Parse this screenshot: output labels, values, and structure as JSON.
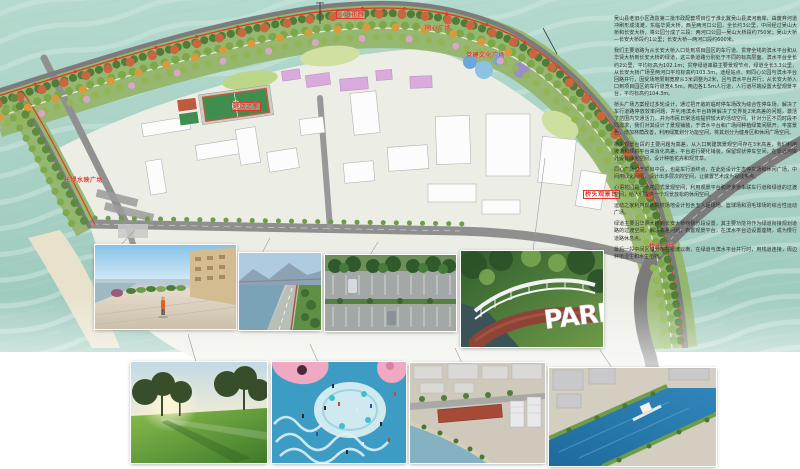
{
  "board": {
    "water_color": "#a6cfc4",
    "label_color": "#e0342b"
  },
  "plan": {
    "labels": [
      {
        "id": "xinyu-garden",
        "text": "心语花园"
      },
      {
        "id": "tongxin-square",
        "text": "同心广场"
      },
      {
        "id": "dangjian-square",
        "text": "党建文化广场"
      },
      {
        "id": "sports-home",
        "text": "运动之家"
      },
      {
        "id": "changdi-square",
        "text": "长堤水映广场"
      },
      {
        "id": "bridgehead-viewdeck",
        "text": "桥头观景台"
      },
      {
        "id": "bridgehead-square",
        "text": "桥头广场"
      }
    ]
  },
  "description": {
    "paragraphs": [
      "吴山县老旧小区改造第二批市政配套项目位于淮北翼吴山县滨河南岸，由废弃河道冲刷形成浅滩，东临华贤大桥，西至两河口公园，全长约3公里，中间经过吴山大桥和长安大桥，将公园分成了三段：两河口公园—吴山大桥段约750米；吴山大桥—长安大桥段约1公里；长安大桥—两河口段约600米。",
      "我们主要道路为从长安大桥入口处到项目园区的车行道、贯穿全线的滨水平台和从华贤大桥到长安大桥的绿道，这三条道路分别处于不同的标高层面。滨水平台全长约2公里，平均标高为102.1m；贯穿绿道串联主要景观节点，绿道全长3.3公里，从长安大桥广场至两河口平均标高约103.3m，途经站点、到同心公园与滨水平台回路并行，因受场地限制宽度从3米调整为2米，且与滨水平台并行；从长安大桥入口到项目园区的车行道宽4.5m，两边各1.5m人行道，人行道尽端设置大型观景平台，平均标高约104.3m。",
      "桥头广场方案经过多轮设计，通过把开敞的临时停车场改为综合性停车场，解决了车行道路停放效率问题，并利用滨水平台转换解决了交界处2米高差的问题，激活了范围内交通活力，并为市民日常活动提供较大的活动空间。针对分区不同时段不同需求，我们对其设计了景观铺装，于滨水平台和广场间种植绿篱间隔开，丰富景色，增加林荫改善，利用绿篱划分功能空间，将其划分为健身区和休闲广场空间。",
      "桥头观景台段的主要问题为高差，从入口到建筑景观空间存在3米高差，我们利用坡道和倾斜平台来消化高差，平台进行硬化铺装，保留现状停车空间，在靠近河岸处设有绿化空间，设计种植花卉和观赏草。",
      "同心广场位于项目中段，也是车行道终点，在此处设计生态停车场和休闲广场，中间用绿化间隔，设计出多层次的空间，让装置艺术成为视线焦点。",
      "心语花园是一个花园式景观空间，利用观景平台和游步道串联车行道和绿道的过渡空间，给人们提供一个观景放松的休闲空间。",
      "运动之家利用现状院校场地设计包含五人足球场、篮球场和羽毛球场的综合性运动广场。",
      "绿道主要沿华贤大桥到长安大桥两侧分段设置，其主要功能将作为绿道衔接规划道路的过渡空间，解决高差问题，布置观景平台，在滨水平台边设置座椅，成为慢行道路休息点。",
      "最后一段中间区域分布在银滩以南，在绿道与滨水平台并行时，用栈道连接，周边种植湿生和水生植物。"
    ]
  },
  "photos": {
    "park_text": "PARK"
  }
}
